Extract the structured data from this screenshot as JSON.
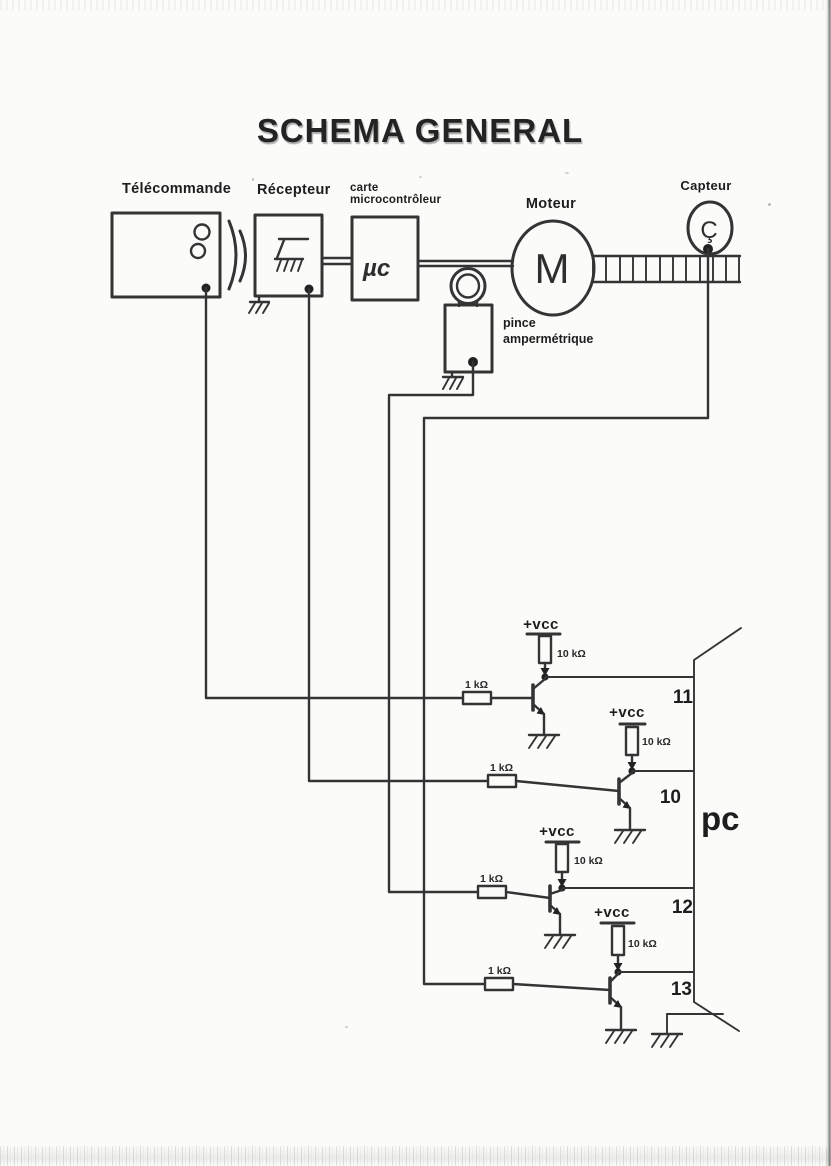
{
  "title": "SCHEMA GENERAL",
  "components": {
    "telecommande": {
      "label": "Télécommande"
    },
    "recepteur": {
      "label": "Récepteur"
    },
    "carte_micro": {
      "label_line1": "carte",
      "label_line2": "microcontrôleur",
      "symbol": "µc"
    },
    "moteur": {
      "label": "Moteur",
      "symbol": "M"
    },
    "capteur": {
      "label": "Capteur",
      "symbol": "Ç"
    },
    "pince": {
      "label_line1": "pince",
      "label_line2": "ampermétrique"
    }
  },
  "circuit": {
    "vcc_label": "+vcc",
    "pullup_resistor": "10 kΩ",
    "base_resistor": "1 kΩ"
  },
  "pc": {
    "label": "pc",
    "pins": [
      "11",
      "10",
      "12",
      "13"
    ]
  },
  "colors": {
    "ink": "#343434",
    "paper": "#fbfbf9"
  }
}
